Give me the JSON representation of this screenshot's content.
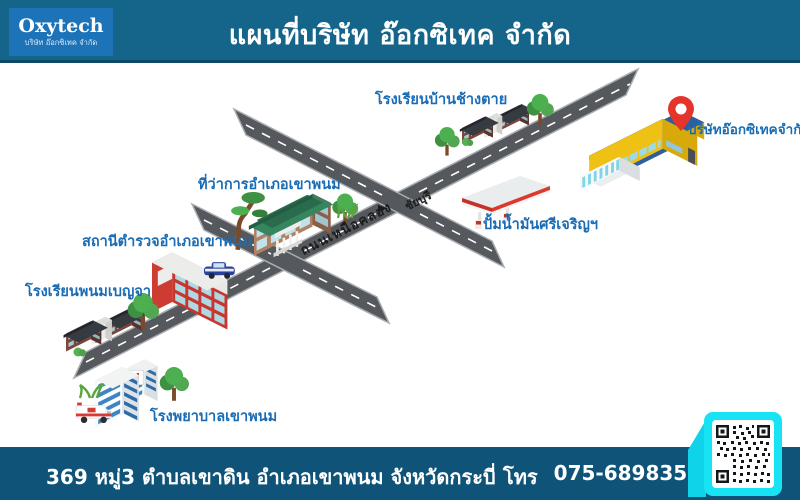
{
  "header": {
    "logo": {
      "title": "Oxytech",
      "subtitle": "บริษัท อ๊อกซิเทค จำกัด"
    },
    "title": "แผนที่บริษัท อ๊อกซิเทค จำกัด"
  },
  "map": {
    "labels": {
      "school_north": "โรงเรียนบ้านช้างตาย",
      "company": "บริษัทอ๊อกซิเทคจำกัด",
      "district_office": "ที่ว่าการอำเภอเขาพนม",
      "gas_station": "ปั้มน้ำมันศรีเจริญฯ",
      "police_station": "สถานีตำรวจอำเภอเขาพนม",
      "school_west": "โรงเรียนพนมเบญจา",
      "hospital": "โรงพยาบาลเขาพนม"
    },
    "road_labels": {
      "main": "ถนนเหนือคลอง",
      "direction": "ชัยบุรี"
    },
    "hospital_sign": "H"
  },
  "footer": {
    "address": "369 หมู่3 ตำบลเขาดิน อำเภอเขาพนม จังหวัดกระบี่",
    "phone_prefix": "โทร",
    "phone_number": "075-689835"
  },
  "colors": {
    "header_bg": "#15648A",
    "footer_bg": "#0F5478",
    "logo_bg": "#1D73B8",
    "label_blue": "#1A6CB4",
    "road_gray": "#55585C",
    "pin_red": "#E5352B",
    "qr_frame_cyan": "#17E3F4",
    "company_yellow": "#F0C115",
    "company_roof_blue": "#2D5F9F"
  }
}
